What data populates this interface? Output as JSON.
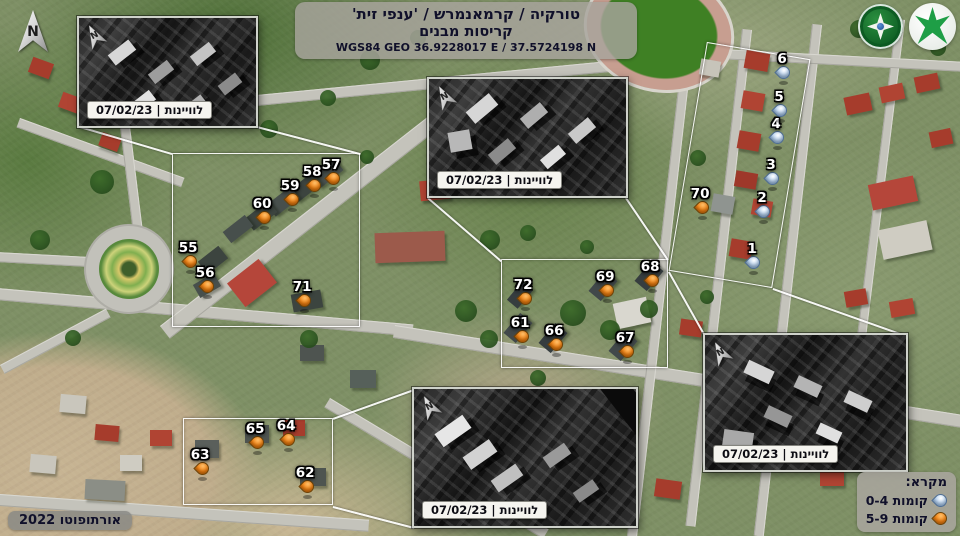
{
  "header": {
    "line1": "טורקיה / קרמאנמרש / 'ענפי זית'",
    "line2": "קריסות מבנים",
    "line3": "WGS84 GEO 36.9228017 E / 37.5724198 N"
  },
  "north_label": "N",
  "insets": [
    {
      "id": "top-left",
      "label": "לוויינות | 07/02/23"
    },
    {
      "id": "top-center",
      "label": "לוויינות | 07/02/23"
    },
    {
      "id": "bottom-center",
      "label": "לוויינות | 07/02/23"
    },
    {
      "id": "right",
      "label": "לוויינות | 07/02/23"
    }
  ],
  "legend": {
    "title": "מקרא:",
    "items": [
      {
        "label": "0-4 קומות",
        "pin": "blue"
      },
      {
        "label": "5-9 קומות",
        "pin": "orange"
      }
    ]
  },
  "source_label": "אורתופוטו 2022",
  "colors": {
    "marker_orange": "#f58414",
    "marker_blue": "#b5d2f2",
    "area_outline": "#ffffff",
    "logo_green": "#1e9e46"
  },
  "markers": [
    {
      "num": "55",
      "color": "orange",
      "x": 190,
      "y": 272
    },
    {
      "num": "56",
      "color": "orange",
      "x": 207,
      "y": 297
    },
    {
      "num": "57",
      "color": "orange",
      "x": 333,
      "y": 189
    },
    {
      "num": "58",
      "color": "orange",
      "x": 314,
      "y": 196
    },
    {
      "num": "59",
      "color": "orange",
      "x": 292,
      "y": 210
    },
    {
      "num": "60",
      "color": "orange",
      "x": 264,
      "y": 228
    },
    {
      "num": "61",
      "color": "orange",
      "x": 522,
      "y": 347
    },
    {
      "num": "62",
      "color": "orange",
      "x": 307,
      "y": 497
    },
    {
      "num": "63",
      "color": "orange",
      "x": 202,
      "y": 479
    },
    {
      "num": "64",
      "color": "orange",
      "x": 288,
      "y": 450
    },
    {
      "num": "65",
      "color": "orange",
      "x": 257,
      "y": 453
    },
    {
      "num": "66",
      "color": "orange",
      "x": 556,
      "y": 355
    },
    {
      "num": "67",
      "color": "orange",
      "x": 627,
      "y": 362
    },
    {
      "num": "68",
      "color": "orange",
      "x": 652,
      "y": 291
    },
    {
      "num": "69",
      "color": "orange",
      "x": 607,
      "y": 301
    },
    {
      "num": "70",
      "color": "orange",
      "x": 702,
      "y": 218
    },
    {
      "num": "71",
      "color": "orange",
      "x": 304,
      "y": 311
    },
    {
      "num": "72",
      "color": "orange",
      "x": 525,
      "y": 309
    },
    {
      "num": "1",
      "color": "blue",
      "x": 753,
      "y": 273
    },
    {
      "num": "2",
      "color": "blue",
      "x": 763,
      "y": 222
    },
    {
      "num": "3",
      "color": "blue",
      "x": 772,
      "y": 189
    },
    {
      "num": "4",
      "color": "blue",
      "x": 777,
      "y": 148
    },
    {
      "num": "5",
      "color": "blue",
      "x": 780,
      "y": 121
    },
    {
      "num": "6",
      "color": "blue",
      "x": 783,
      "y": 83
    }
  ]
}
